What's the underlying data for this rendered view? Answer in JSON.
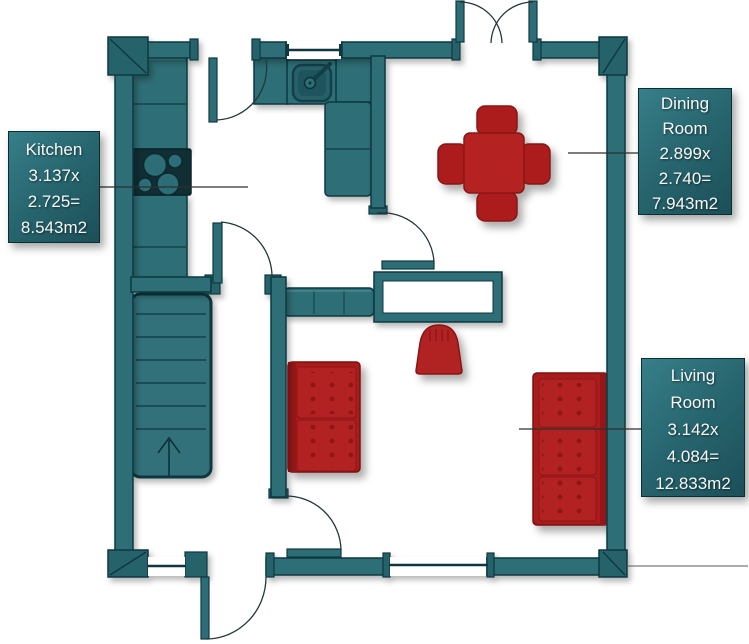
{
  "title": "Ground floor plan",
  "labels": {
    "kitchen": {
      "lines": [
        "Kitchen",
        "3.137x",
        "2.725=",
        "8.543m2"
      ]
    },
    "dining": {
      "lines": [
        "Dining",
        "Room",
        "2.899x",
        "2.740=",
        "7.943m2"
      ]
    },
    "living": {
      "lines": [
        "Living",
        "Room",
        "3.142x",
        "4.084=",
        "12.833m2"
      ]
    }
  },
  "rooms": [
    {
      "name": "Kitchen",
      "width_m": "3.137",
      "depth_m": "2.725",
      "area_m2": "8.543"
    },
    {
      "name": "Dining Room",
      "width_m": "2.899",
      "depth_m": "2.740",
      "area_m2": "7.943"
    },
    {
      "name": "Living Room",
      "width_m": "3.142",
      "depth_m": "4.084",
      "area_m2": "12.833"
    }
  ],
  "colors": {
    "wall_teal": "#2D6E76",
    "wall_outline": "#113840",
    "furniture_red": "#B12020",
    "furniture_red_dark": "#8A1212",
    "label_gradient_top": "#377F89",
    "label_gradient_bottom": "#1C4F58",
    "label_text": "#F6F8F8",
    "leader_line": "#2F2F2F",
    "floor": "#FFFFFF"
  },
  "furniture": [
    "kitchen-counter",
    "hob",
    "sink",
    "stairs",
    "bench",
    "console-table",
    "dining-table",
    "dining-chairs",
    "armchair",
    "sofa-2-seat",
    "sofa-3-seat"
  ],
  "doors": [
    "kitchen-top-door",
    "french-doors",
    "kitchen-hall-door",
    "kitchen-dining-door",
    "living-room-door",
    "front-door"
  ],
  "windows": [
    "top-window",
    "bottom-left-window",
    "bottom-right-window"
  ]
}
